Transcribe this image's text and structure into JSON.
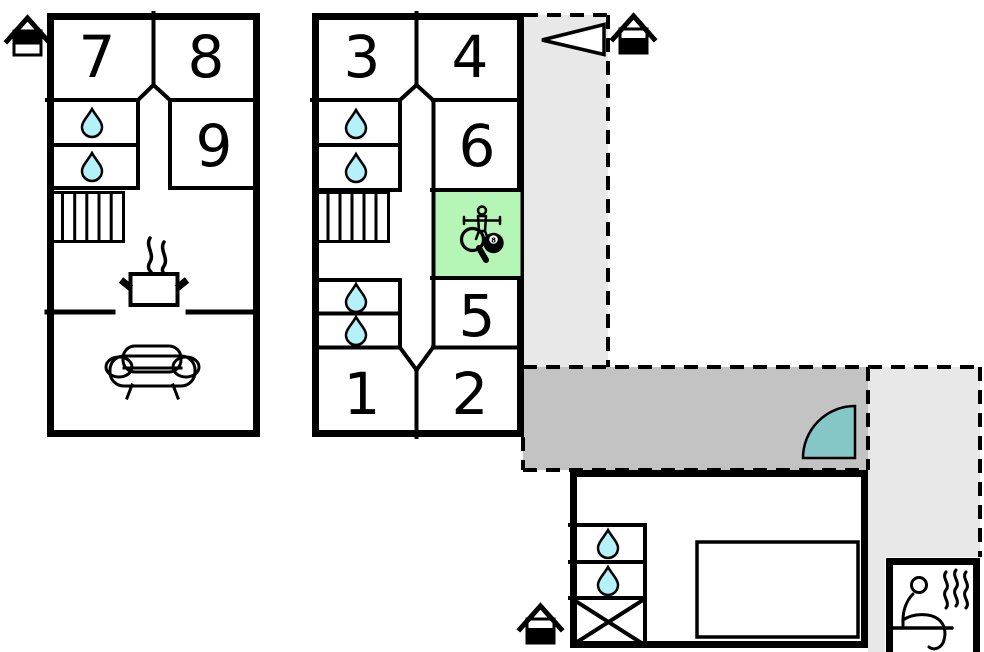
{
  "rooms": {
    "n1": "1",
    "n2": "2",
    "n3": "3",
    "n4": "4",
    "n5": "5",
    "n6": "6",
    "n7": "7",
    "n8": "8",
    "n9": "9"
  },
  "billiard_ball": "8",
  "colors": {
    "wall": "#000000",
    "game_room_fill": "#b5f5b5",
    "water_drop_fill": "#b4f1f9",
    "pool_fill": "#b6f8fc",
    "door_swing_fill": "#85c6c6",
    "terrace_dark_fill": "#c3c3c3",
    "terrace_light_fill": "#e8e8e8",
    "steam_color": "#8f8f8f"
  },
  "icons": {
    "upper_floor_house": "house-upper-floor-icon",
    "ground_floor_house": "house-ground-floor-icon",
    "entrance_arrow": "entrance-arrow-icon",
    "water_drop": "water-drop-icon",
    "stairs": "stairs-icon",
    "cooking_pot": "cooking-pot-icon",
    "sofa": "sofa-icon",
    "table_tennis": "table-tennis-paddle-icon",
    "foosball": "foosball-player-icon",
    "billiards": "billiard-ball-icon",
    "door_swing": "door-swing-icon",
    "pool": "swimming-pool-icon",
    "storage": "storage-cross-icon",
    "sauna": "sauna-person-icon"
  }
}
